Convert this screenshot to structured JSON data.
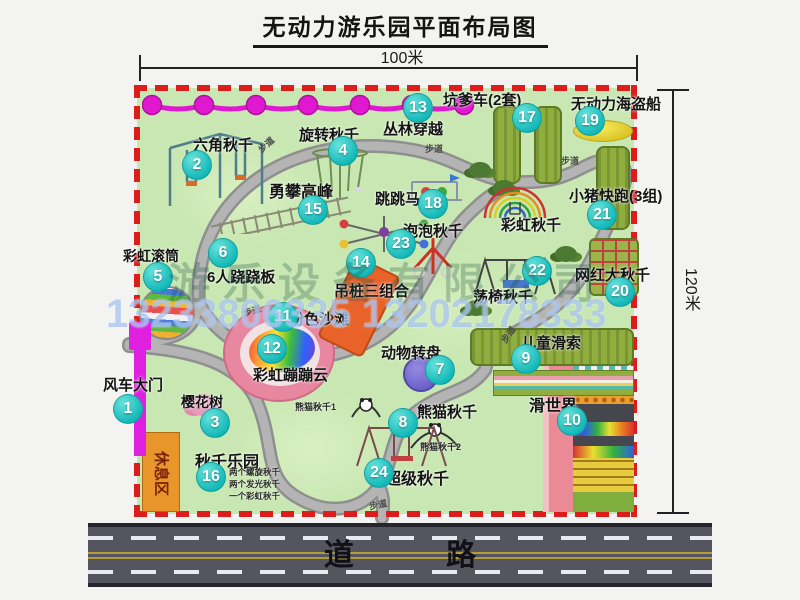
{
  "title": "无动力游乐园平面布局图",
  "dimensions": {
    "width_label": "100米",
    "height_label": "120米"
  },
  "road": {
    "label": "道 路"
  },
  "watermark": {
    "company": "游乐设备有限公司",
    "phone": "13233806335 13202178333"
  },
  "rest_area": {
    "label": "休息区"
  },
  "path_labels": [
    "步道",
    "步道",
    "步道",
    "步道",
    "步道",
    "步道"
  ],
  "attractions": [
    {
      "num": "1",
      "label": "风车大门"
    },
    {
      "num": "2",
      "label": "六角秋千"
    },
    {
      "num": "3",
      "label": "樱花树"
    },
    {
      "num": "4",
      "label": "旋转秋千"
    },
    {
      "num": "5",
      "label": "彩虹滚筒"
    },
    {
      "num": "6",
      "label": "6人跷跷板"
    },
    {
      "num": "7",
      "label": "动物转盘"
    },
    {
      "num": "8",
      "label": "熊猫秋千"
    },
    {
      "num": "9",
      "label": "儿童滑索"
    },
    {
      "num": "10",
      "label": "滑世界"
    },
    {
      "num": "11",
      "label": "粉色沙滩"
    },
    {
      "num": "12",
      "label": "彩虹蹦蹦云"
    },
    {
      "num": "13",
      "label": "丛林穿越"
    },
    {
      "num": "14",
      "label": "吊桩三组合"
    },
    {
      "num": "15",
      "label": "勇攀高峰"
    },
    {
      "num": "16",
      "label": "秋千乐园"
    },
    {
      "num": "17",
      "label": "坑爹车(2套)"
    },
    {
      "num": "18",
      "label": "跳跳马"
    },
    {
      "num": "19",
      "label": "无动力海盗船"
    },
    {
      "num": "20",
      "label": "网红大秋千"
    },
    {
      "num": "21",
      "label": "小猪快跑(3组)"
    },
    {
      "num": "22",
      "label": "荡椅秋千"
    },
    {
      "num": "23",
      "label": "泡泡秋千"
    },
    {
      "num": "24",
      "label": "超级秋千"
    },
    {
      "num": "",
      "label": "彩虹秋千"
    }
  ],
  "notes": {
    "swing_park": [
      "两个螺旋秋千",
      "两个发光秋千",
      "一个彩虹秋千"
    ],
    "panda_1": "熊猫秋千1",
    "panda_2": "熊猫秋千2"
  },
  "colors": {
    "map_green": "#c8e7b2",
    "border_red": "#dd1c1c",
    "badge_teal": "#12b8b8",
    "chain_magenta": "#e018d0",
    "gate_magenta": "#e020e0",
    "equipment_olive": "#8fae3e",
    "road_gray": "#55555f",
    "beach_pink": "#e787a0",
    "turntable_purple": "#6a5fc8",
    "pirate_yellow": "#f0e030",
    "rest_orange": "#e8952c"
  }
}
